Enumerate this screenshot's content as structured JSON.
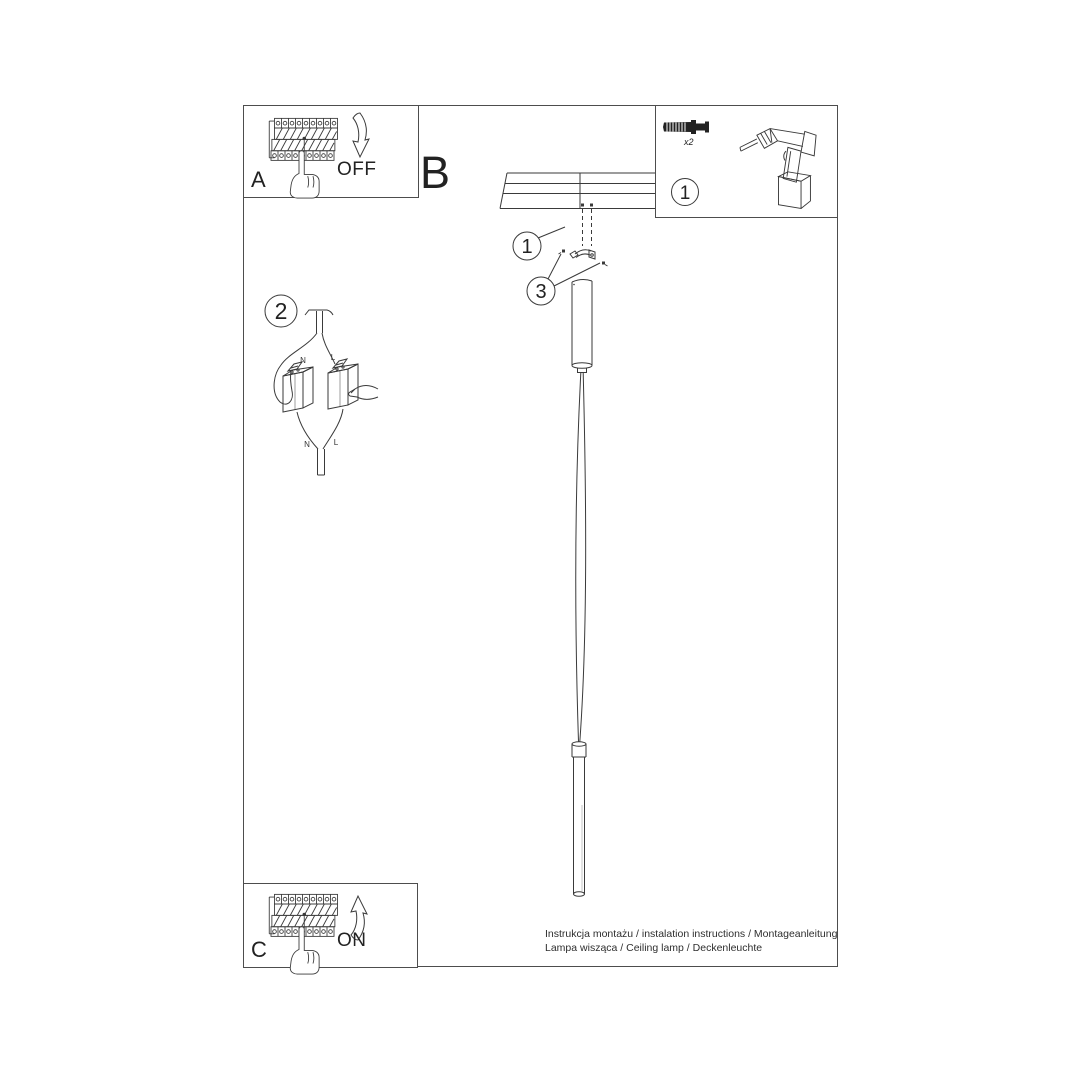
{
  "sheet": {
    "background": "#ffffff",
    "line_color": "#3a3a3a",
    "border_color": "#4d4d4d"
  },
  "steps": {
    "a": {
      "label": "A",
      "switch_state": "OFF"
    },
    "b": {
      "label": "B"
    },
    "c": {
      "label": "C",
      "switch_state": "ON"
    }
  },
  "callouts": {
    "bracket_screws": "1",
    "wiring": "2",
    "mounting_bracket": "3",
    "tools": "1"
  },
  "parts_box": {
    "anchor_quantity": "x2"
  },
  "wiring": {
    "neutral": "N",
    "live": "L"
  },
  "caption": {
    "line1": "Instrukcja montażu / instalation instructions / Montageanleitung",
    "line2": "Lampa wisząca / Ceiling lamp / Deckenleuchte"
  }
}
